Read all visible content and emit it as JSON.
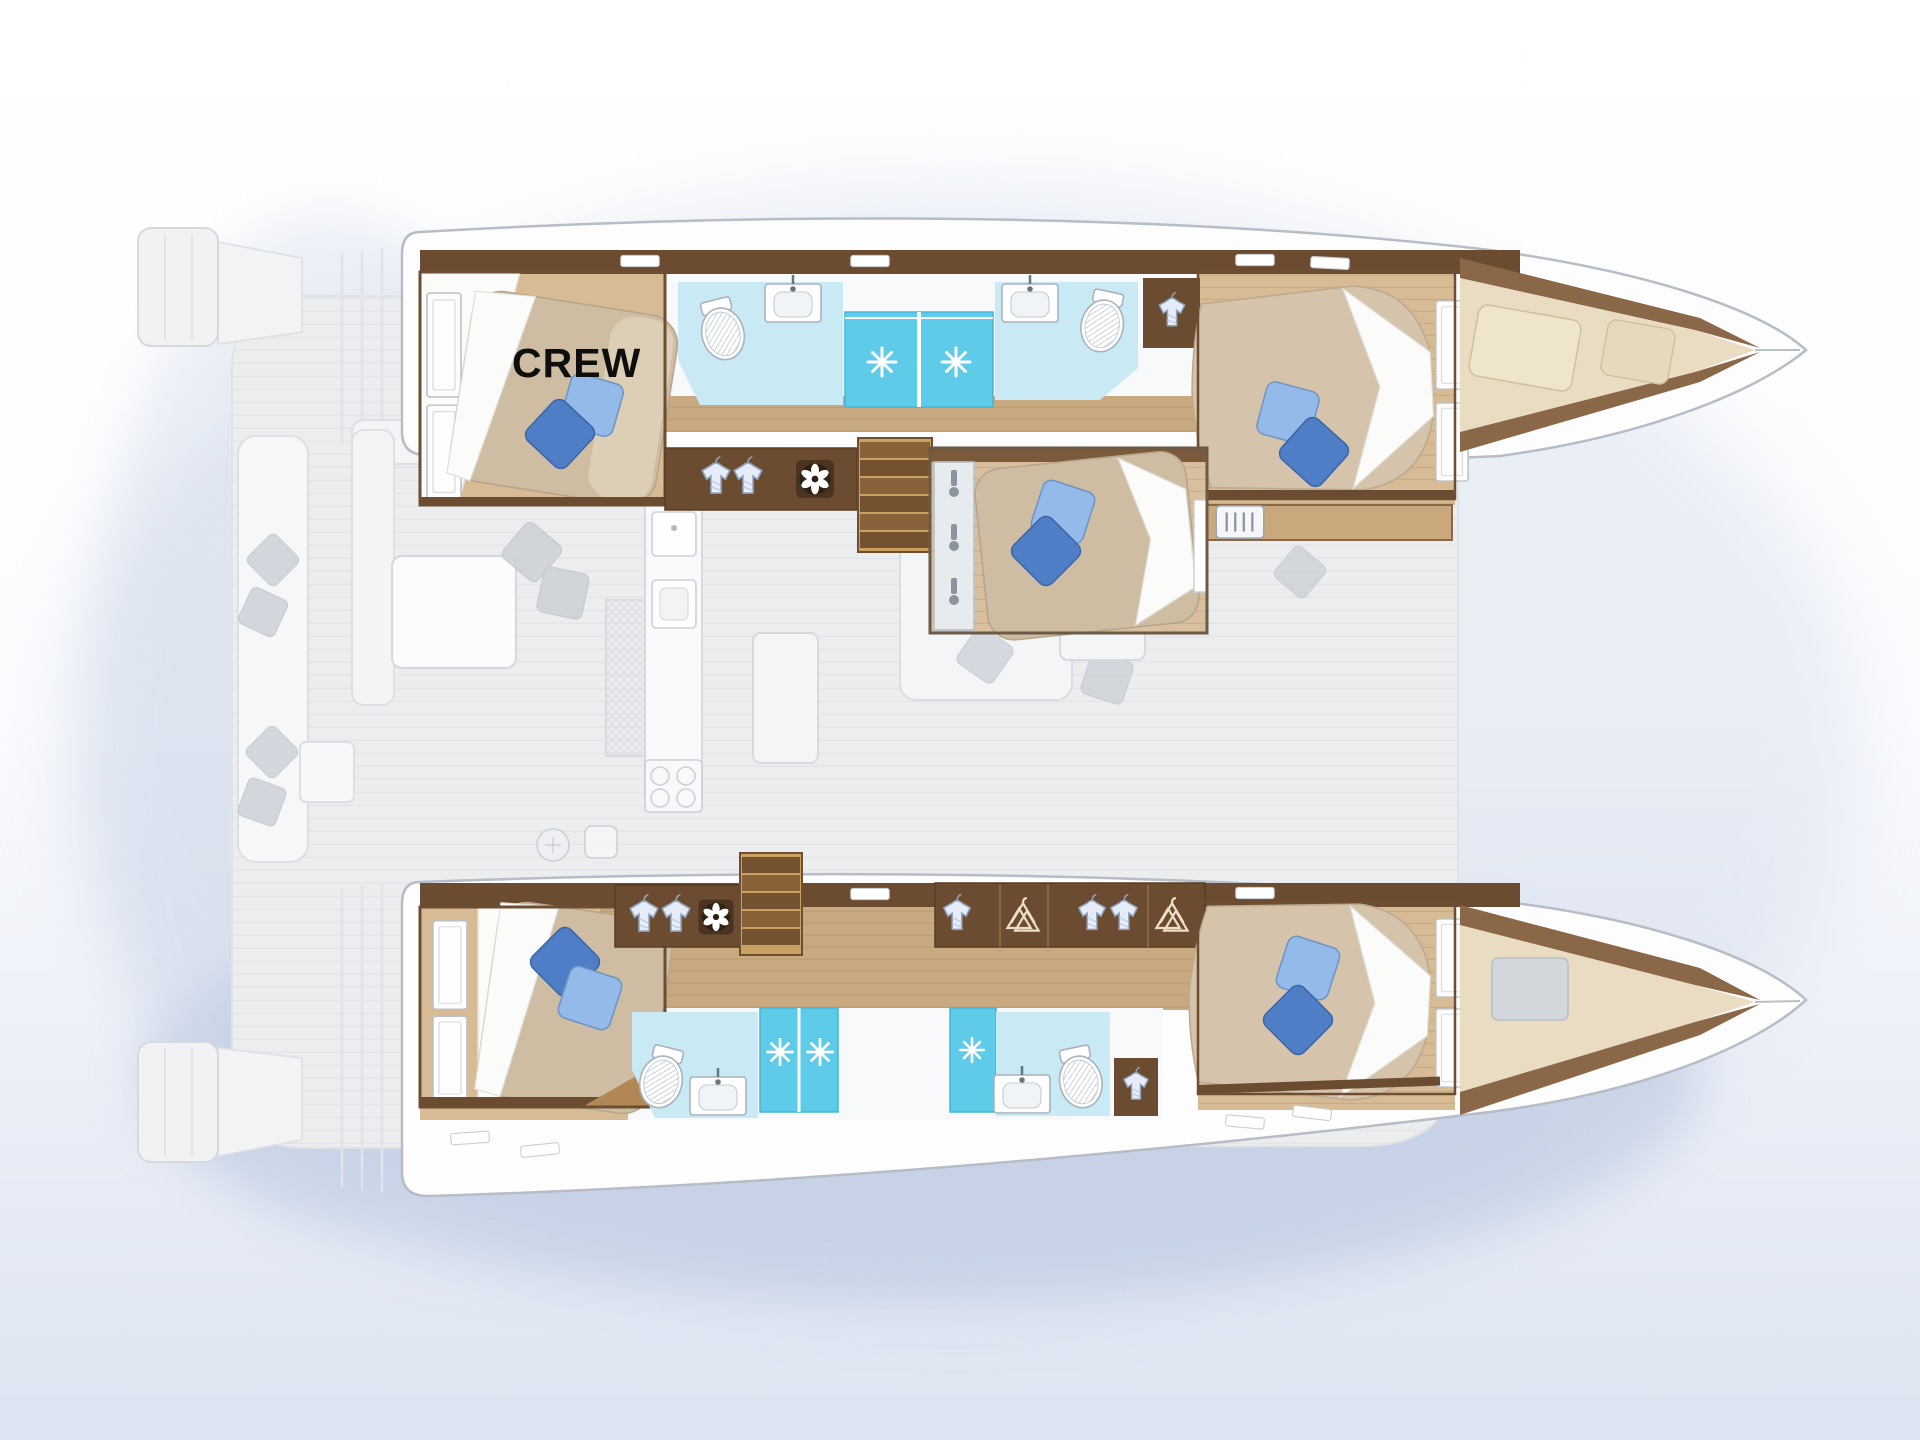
{
  "labels": {
    "crew": "CREW"
  },
  "palette": {
    "background_top": "#ffffff",
    "background_bottom": "#dde4f1",
    "boat_shadow": "#bfcbe2",
    "hull_fill": "#fdfdfe",
    "hull_outline": "#b6bdc6",
    "deck_fill": "#ecedef",
    "deck_line": "#e2e4e8",
    "wood_floor": "#d6bb94",
    "wood_corridor": "#c9a97f",
    "wood_trim_dark": "#6b4c30",
    "wood_trim_mid": "#8a6746",
    "bed_cover": "#cfbda3",
    "bed_linen_white": "#fbfbf9",
    "pillow_dark_blue": "#4f7ec6",
    "pillow_light_blue": "#93bae8",
    "bathroom_floor_cyan": "#c9e9f4",
    "shower_floor_cyan": "#5ecbe9",
    "washed_furniture_gray": "#cdd1d7",
    "crew_text_color": "#0e0e0e"
  },
  "icons": [
    "toilet-icon",
    "sink-icon",
    "shower-sparkle-icon",
    "wardrobe-shirt-icon",
    "clothes-hangers-icon",
    "ventilation-fan-icon",
    "air-vent-grille-icon",
    "companionway-stairs",
    "window-slit",
    "wardrobe-door",
    "bed-pillow"
  ],
  "features": {
    "hulls": 2,
    "double_berth_cabins": 6,
    "bathrooms": 4,
    "shower_stalls": 4,
    "swim_platforms": 2,
    "labeled_cabin": "crew cabin, port aft"
  }
}
